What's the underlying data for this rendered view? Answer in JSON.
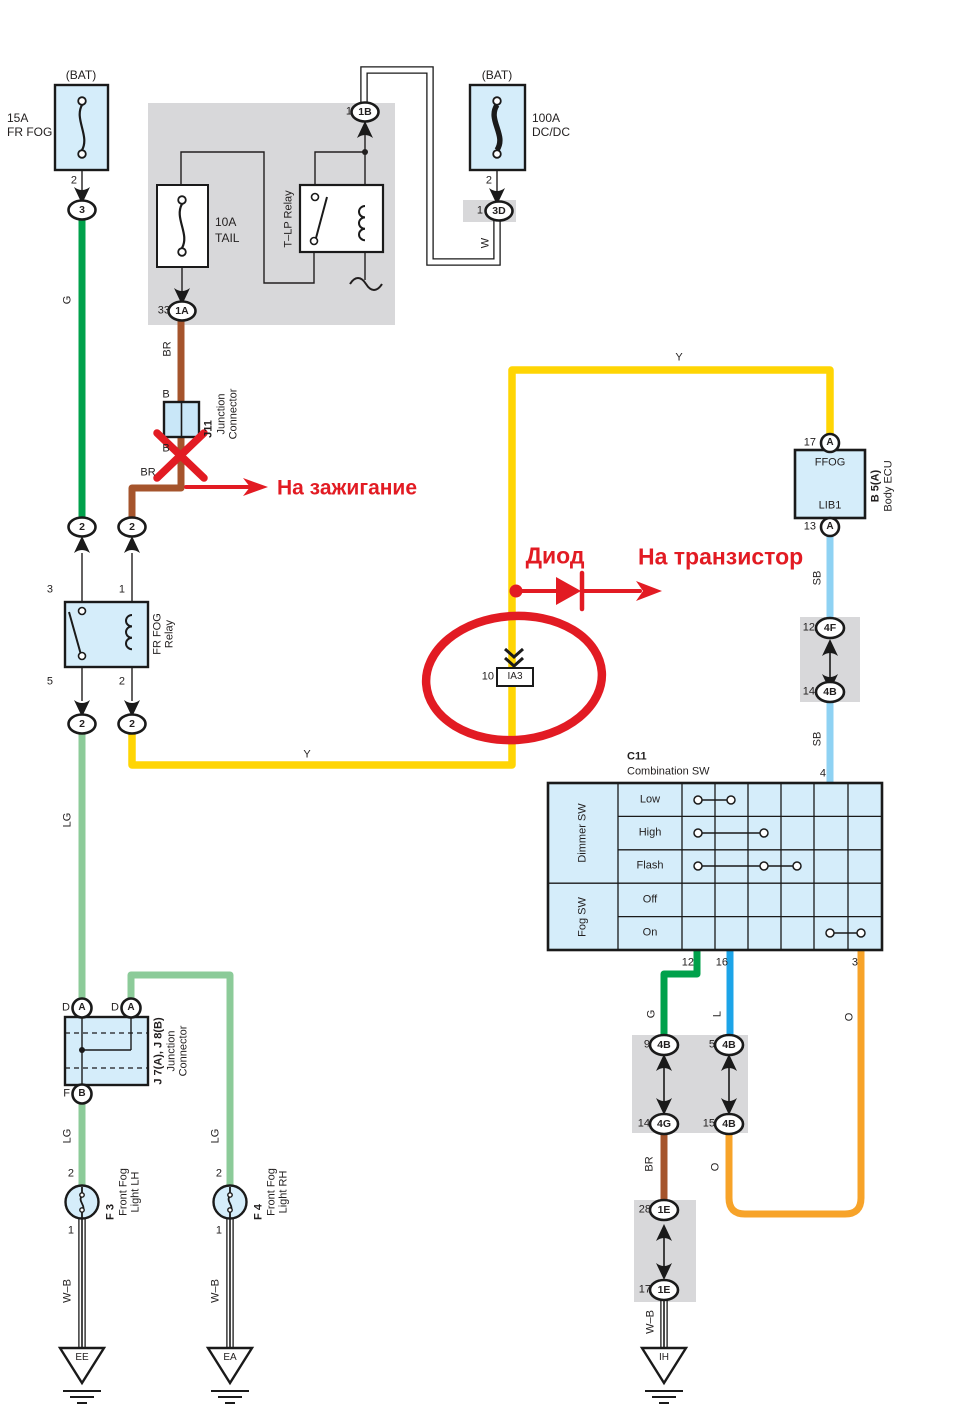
{
  "annotations": {
    "ignition": "На зажигание",
    "diode": "Диод",
    "transistor": "На транзистор"
  },
  "wires": {
    "g": "G",
    "lg": "LG",
    "br": "BR",
    "y": "Y",
    "w": "W",
    "wb": "W–B",
    "sb": "SB",
    "l": "L",
    "o": "O"
  },
  "pins": {
    "n1": "1",
    "n2": "2",
    "n3": "3",
    "n4": "4",
    "n5": "5",
    "n9": "9",
    "n10": "10",
    "n12": "12",
    "n13": "13",
    "n14": "14",
    "n15": "15",
    "n16": "16",
    "n17": "17",
    "n28": "28",
    "n33": "33",
    "b": "B",
    "d": "D",
    "f": "F"
  },
  "connectors": {
    "c3": "3",
    "c1a": "1A",
    "c1b": "1B",
    "c3d": "3D",
    "c2": "2",
    "a": "A",
    "b": "B",
    "c4f": "4F",
    "c4b": "4B",
    "c4g": "4G",
    "c1e": "1E",
    "ia3": "IA3"
  },
  "components": {
    "fuse_fr_fog": {
      "bat": "(BAT)",
      "rating": "15A",
      "name": "FR FOG"
    },
    "fuse_tail": {
      "rating": "10A",
      "name": "TAIL"
    },
    "fuse_dcdc": {
      "bat": "(BAT)",
      "rating": "100A",
      "name": "DC/DC"
    },
    "tlp_relay": {
      "name": "T–LP Relay"
    },
    "fr_fog_relay": {
      "name1": "FR FOG",
      "name2": "Relay"
    },
    "j11": {
      "code": "J11",
      "name1": "Junction",
      "name2": "Connector"
    },
    "body_ecu": {
      "pin_top": "FFOG",
      "pin_bottom": "LIB1",
      "code": "B 5(A)",
      "name": "Body ECU"
    },
    "combination_sw": {
      "code": "C11",
      "name": "Combination SW",
      "group1": "Dimmer SW",
      "group2": "Fog SW",
      "rows": [
        "Low",
        "High",
        "Flash",
        "Off",
        "On"
      ]
    },
    "j7j8": {
      "code": "J 7(A), J 8(B)",
      "name1": "Junction",
      "name2": "Connector"
    },
    "f3": {
      "code": "F 3",
      "name1": "Front Fog",
      "name2": "Light LH"
    },
    "f4": {
      "code": "F 4",
      "name1": "Front Fog",
      "name2": "Light RH"
    },
    "grounds": {
      "ee": "EE",
      "ea": "EA",
      "ih": "IH"
    }
  },
  "colors": {
    "green": "#00A14B",
    "light_green": "#8CCB99",
    "yellow": "#FFD504",
    "brown": "#A5542C",
    "sky_blue": "#8FD2F3",
    "blue": "#1CA4E8",
    "orange": "#F7A329",
    "red": "#E21B23",
    "component_fill": "#D5EDFA",
    "panel_gray": "#D8D8DA"
  }
}
